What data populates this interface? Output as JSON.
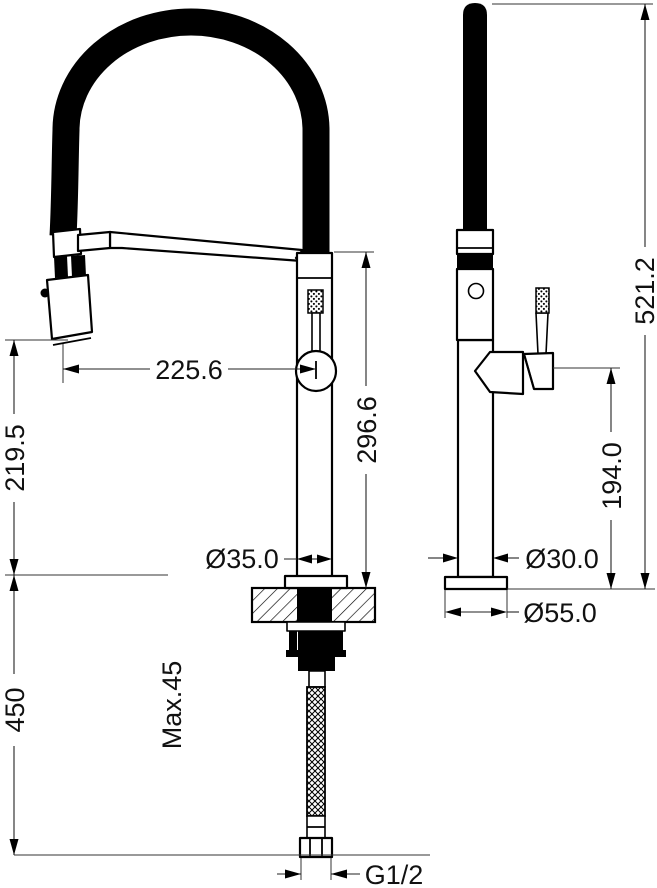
{
  "drawing": {
    "type": "faucet-installation-dimension-drawing",
    "background_color": "#ffffff",
    "line_color": "#000000",
    "dims": {
      "front": {
        "spout_reach": "225.6",
        "spray_head_height": "219.5",
        "body_height": "296.6",
        "under_counter_hose_drop": "450",
        "max_counter_thickness": "Max.45",
        "body_diameter": "Ø35.0",
        "thread_size": "G1/2"
      },
      "side": {
        "overall_height": "521.2",
        "handle_pivot_height": "194.0",
        "column_diameter": "Ø30.0",
        "base_diameter": "Ø55.0"
      }
    }
  }
}
